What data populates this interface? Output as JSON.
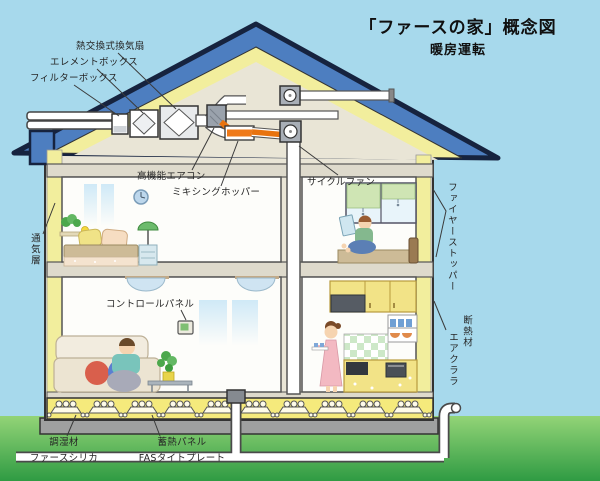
{
  "header": {
    "title": "「ファースの家」概念図",
    "subtitle": "暖房運転"
  },
  "labels": {
    "heat_exchange_fan": "熱交換式換気扇",
    "element_box": "エレメントボックス",
    "filter_box": "フィルターボックス",
    "ventilation_layer": "通気層",
    "high_performance_aircon": "高機能エアコン",
    "mixing_hopper": "ミキシングホッパー",
    "cycle_fan": "サイクルファン",
    "fire_stopper": "ファイヤーストッパー",
    "control_panel": "コントロールパネル",
    "insulation_line1": "断熱材",
    "insulation_line2": "エアクララ",
    "humidity_material_line1": "調湿材",
    "humidity_material_line2": "ファースシリカ",
    "heat_storage_line1": "蓄熱パネル",
    "heat_storage_line2": "FASタイトプレート"
  },
  "colors": {
    "sky": "#a7d9ec",
    "grass_light": "#93d477",
    "grass_dark": "#2f9b43",
    "roof_blue": "#4d7ec0",
    "roof_outline": "#16233f",
    "insulation_yellow": "#f2ee9d",
    "foundation_yellow": "#f5ea7c",
    "heated_air_orange": "#e8730f",
    "structure_beige": "#e9e5d6",
    "duct_white": "#ffffff",
    "unit_gray": "#9aa2ac",
    "slab_gray": "#9fa0a0"
  }
}
